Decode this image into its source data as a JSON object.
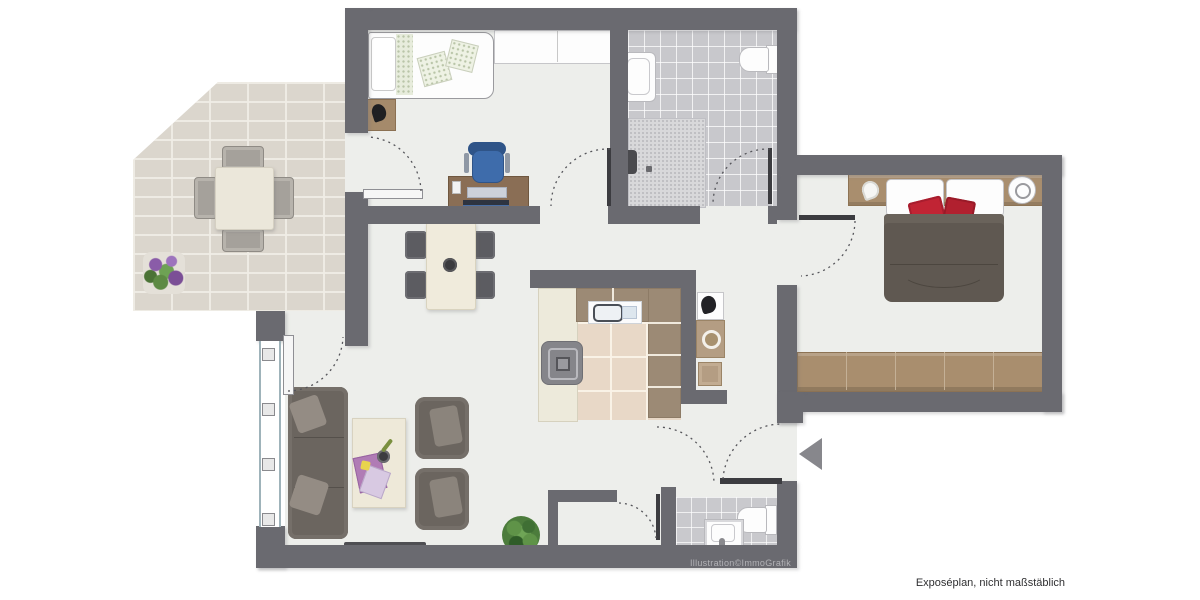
{
  "plan": {
    "type": "apartment-floor-plan",
    "credit_text": "Illustration©ImmoGrafik",
    "disclaimer_text": "Exposéplan, nicht maßstäblich",
    "entrance_arrow_direction": "left",
    "colors": {
      "wall": "#6a6a70",
      "floor": "#edeeeb",
      "terrace_tile": "#dbd6cd",
      "bath_tile": "#c8c8cc",
      "kitchen_tile": "#e8d8c7",
      "counter_brown": "#9c8a75",
      "counter_cream": "#edeadb",
      "wood": "#a98e6e",
      "sofa_gray": "#6b655f",
      "duvet_gray": "#5f5851",
      "accent_red": "#c12434",
      "office_chair_blue": "#3e6cab",
      "arrow_gray": "#87878c"
    },
    "rooms": [
      {
        "id": "terrace",
        "furniture": [
          "outdoor-dining-table",
          "four-outdoor-chairs",
          "flower-planter"
        ]
      },
      {
        "id": "bedroom-1",
        "furniture": [
          "single-bed",
          "nightstand",
          "wardrobe",
          "desk",
          "office-chair"
        ]
      },
      {
        "id": "bathroom",
        "furniture": [
          "washbasin",
          "toilet",
          "shower"
        ]
      },
      {
        "id": "bedroom-2",
        "furniture": [
          "double-bed",
          "nightstand-left",
          "nightstand-right",
          "bedside-lamp",
          "wardrobe-sideboard"
        ]
      },
      {
        "id": "kitchen",
        "furniture": [
          "counter-l-shape",
          "kitchen-sink",
          "stove"
        ]
      },
      {
        "id": "hallway",
        "furniture": [
          "plant-stand",
          "washing-machine",
          "stool"
        ]
      },
      {
        "id": "living-dining-room",
        "furniture": [
          "sofa",
          "coffee-table",
          "armchair-1",
          "armchair-2",
          "dining-table",
          "four-dining-chairs",
          "tv",
          "plant"
        ]
      },
      {
        "id": "wc",
        "furniture": [
          "toilet",
          "washbasin"
        ]
      },
      {
        "id": "storage-niche",
        "furniture": []
      }
    ],
    "doors": [
      "terrace-to-bedroom-1",
      "terrace-to-living-room",
      "hall-to-bedroom-1",
      "hall-to-bathroom",
      "hall-to-bedroom-2",
      "entrance-door",
      "wc-door",
      "niche-door"
    ]
  }
}
